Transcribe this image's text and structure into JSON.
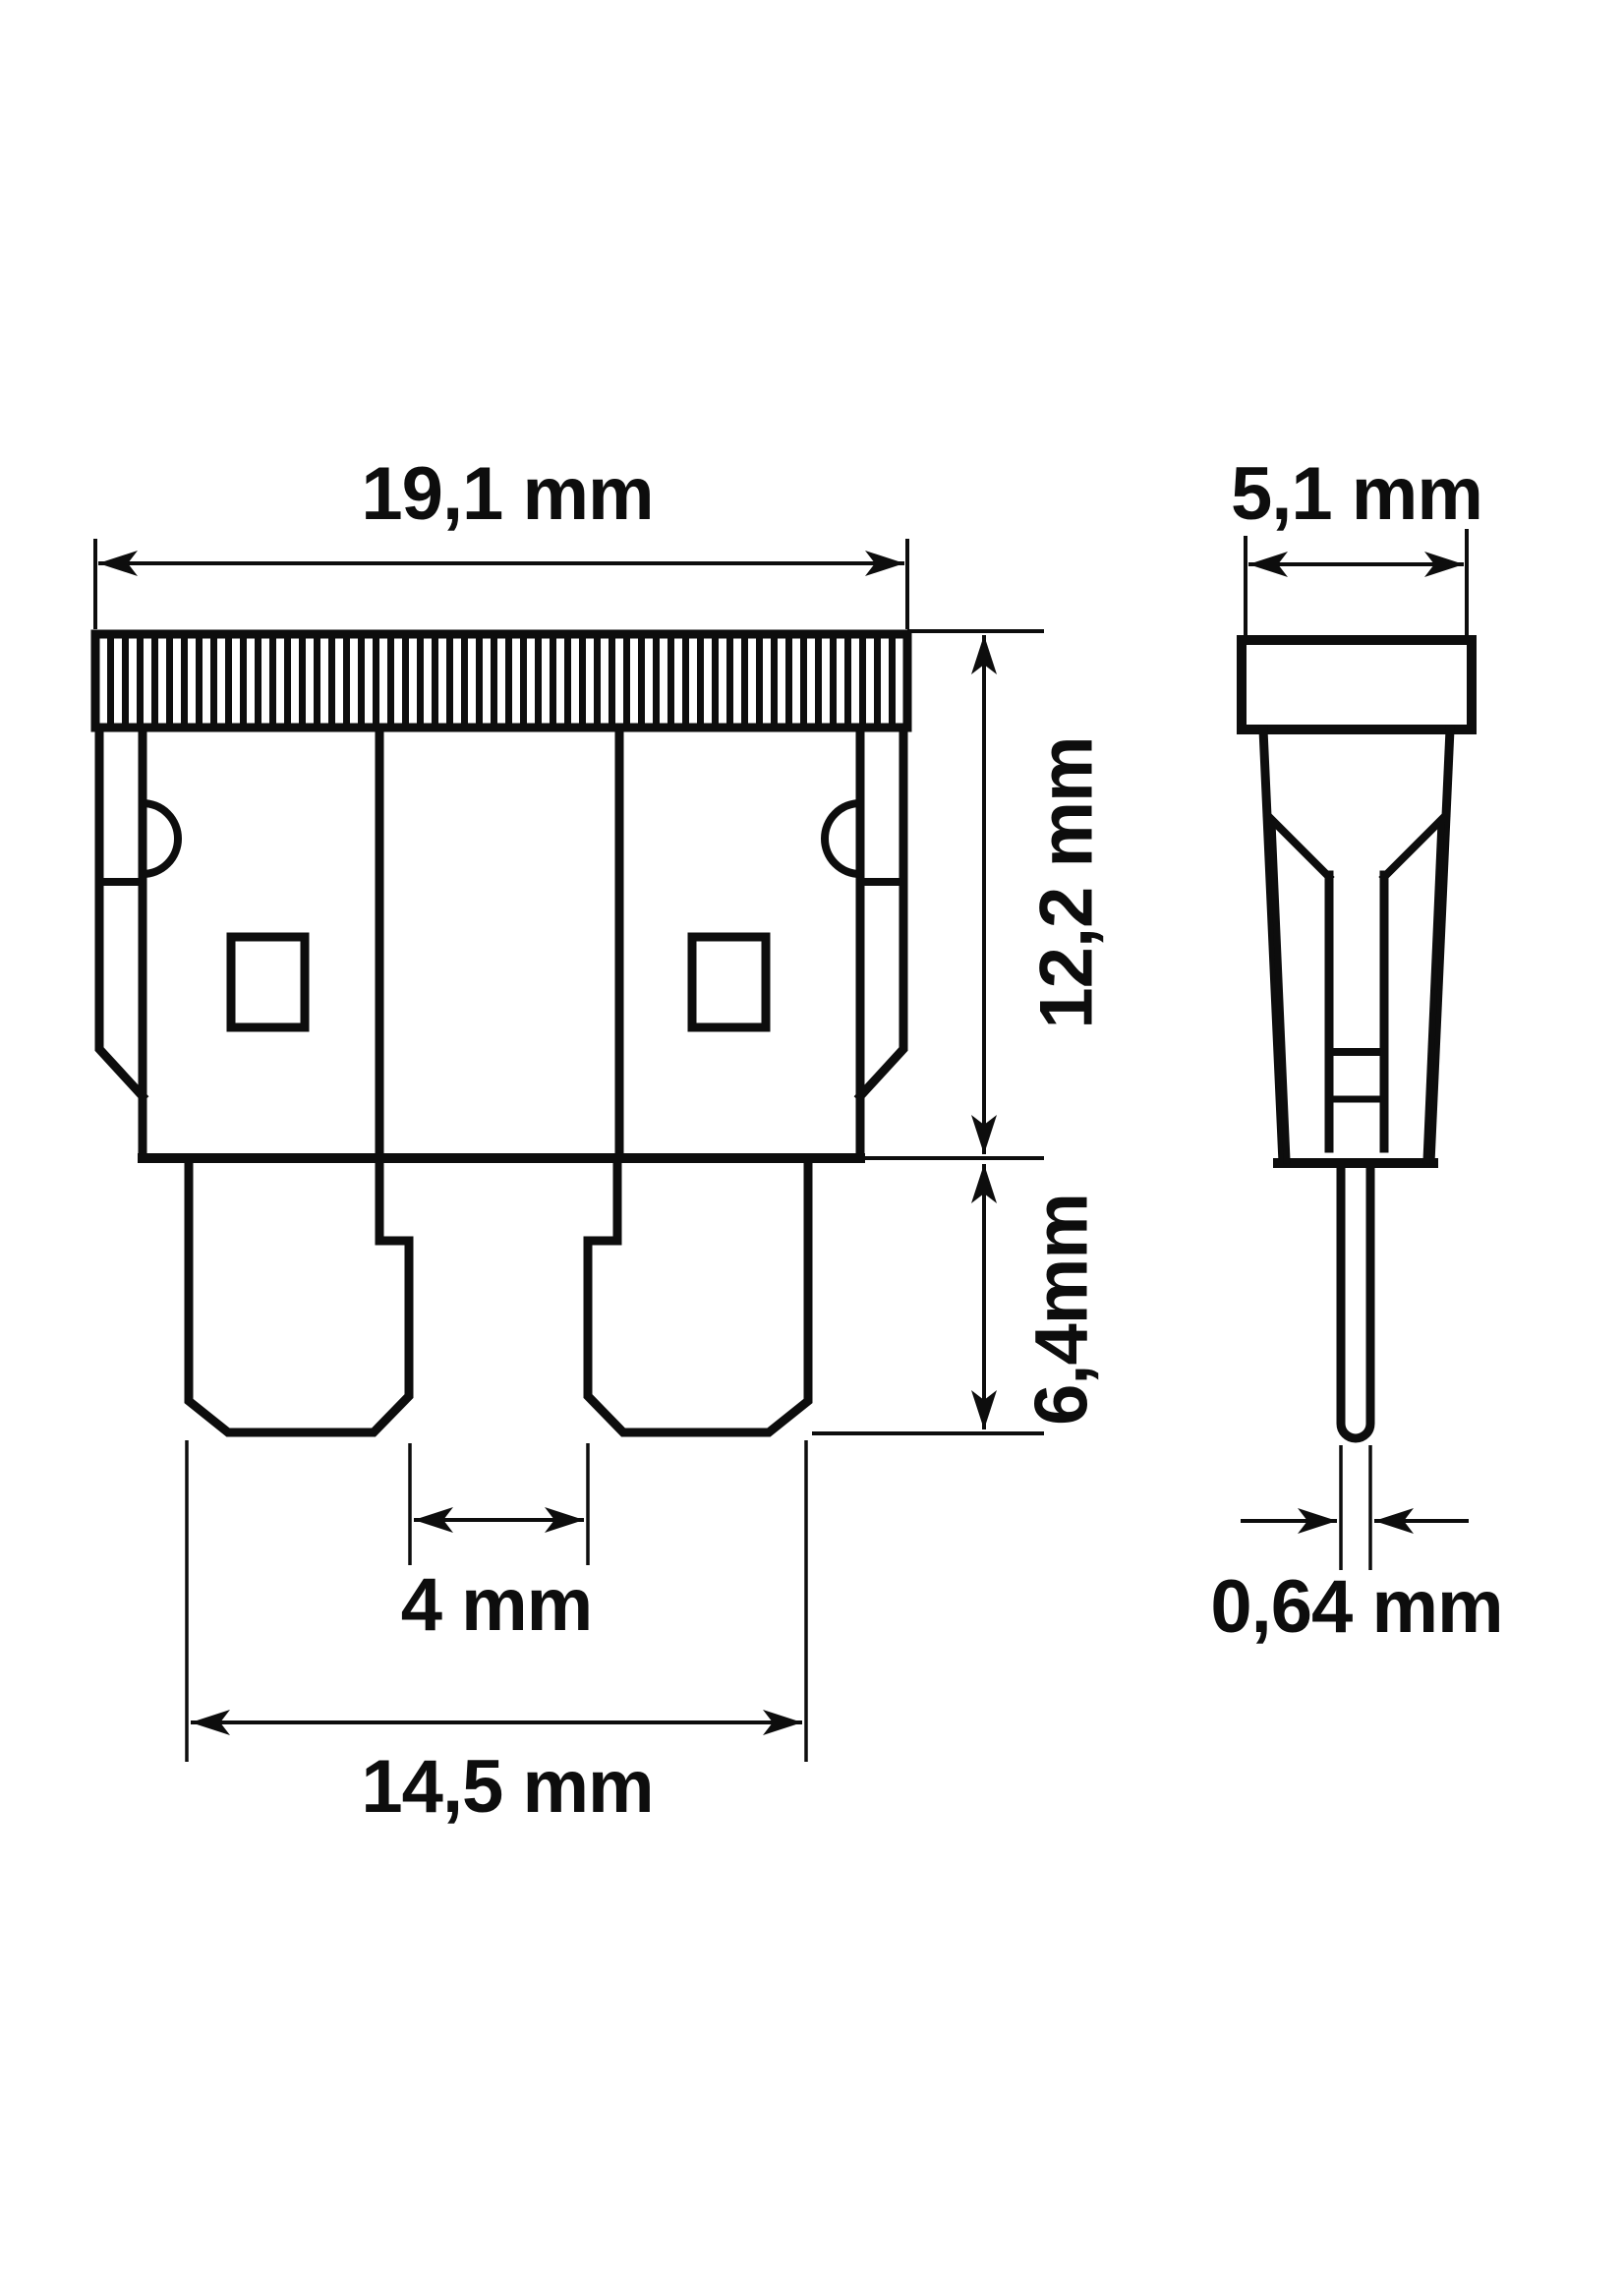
{
  "drawing": {
    "type": "technical-dimension-drawing",
    "subject": "automotive blade fuse",
    "front_view": {
      "width_label": "19,1 mm",
      "body_height_label": "12,2 mm",
      "blade_length_label": "6,4mm",
      "blade_gap_label": "4 mm",
      "blade_span_label": "14,5 mm"
    },
    "side_view": {
      "thickness_label": "5,1 mm",
      "blade_thickness_label": "0,64 mm"
    },
    "colors": {
      "line": "#0d0d0d",
      "background": "#ffffff"
    }
  }
}
